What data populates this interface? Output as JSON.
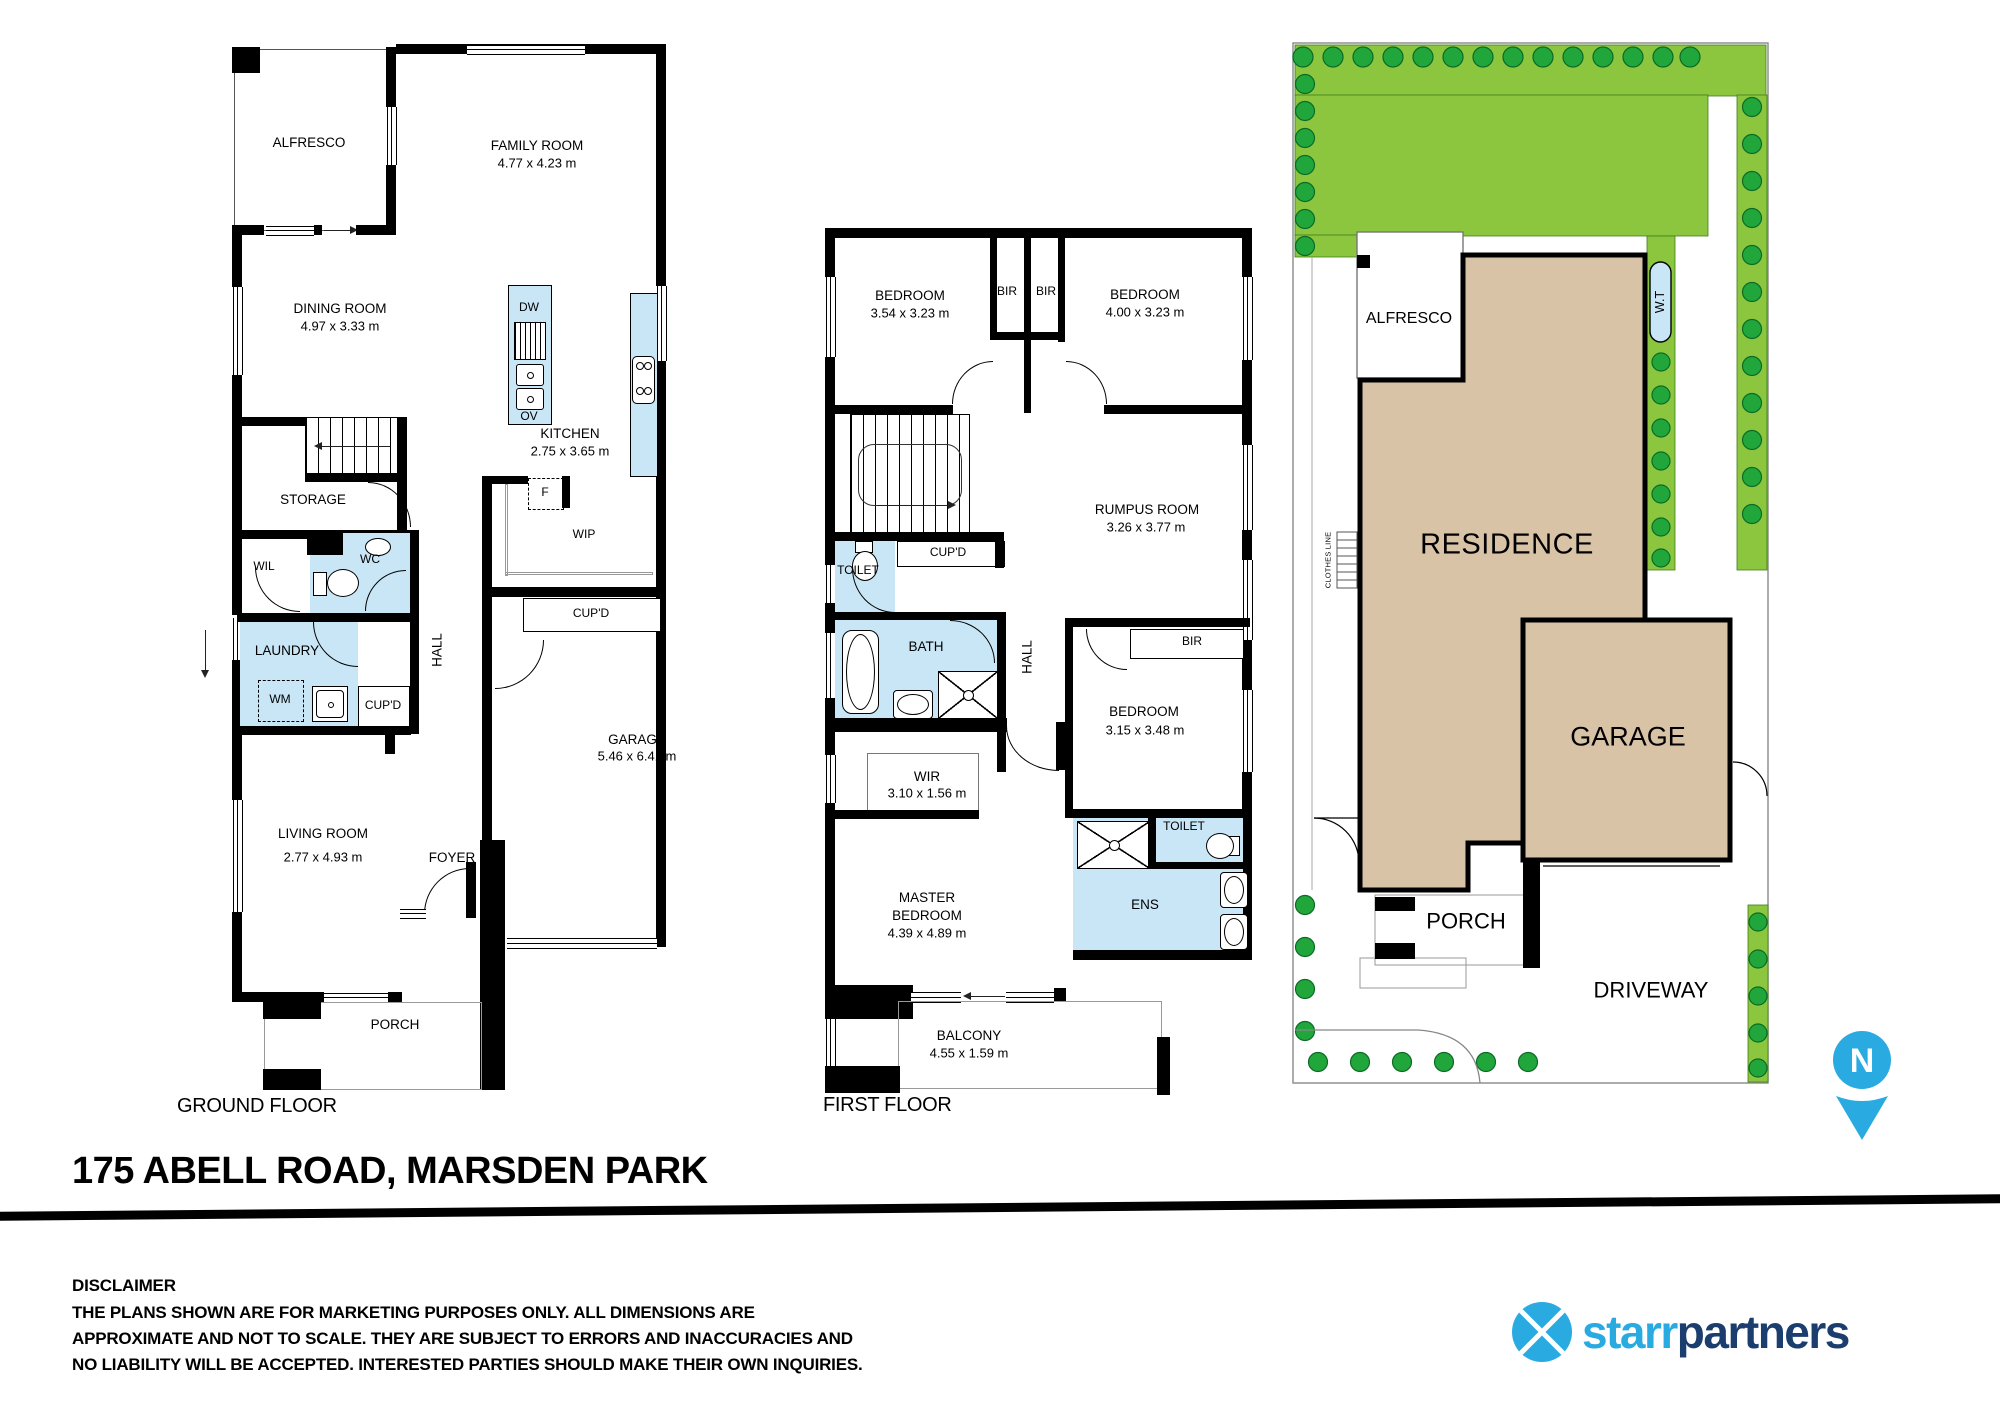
{
  "gf": {
    "floor": "GROUND FLOOR",
    "alfresco": "ALFRESCO",
    "family": {
      "n": "FAMILY ROOM",
      "d": "4.77 x 4.23 m"
    },
    "dining": {
      "n": "DINING ROOM",
      "d": "4.97 x 3.33 m"
    },
    "kitchen": {
      "n": "KITCHEN",
      "d": "2.75 x 3.65 m"
    },
    "dw": "DW",
    "ov": "OV",
    "fridge": "F",
    "wip": "WIP",
    "storage": "STORAGE",
    "wil": "WIL",
    "wc": "WC",
    "laundry": "LAUNDRY",
    "wm": "WM",
    "cupd_hall": "CUP'D",
    "hall": "HALL",
    "cupd_garage": "CUP'D",
    "garage": {
      "n": "GARAGE",
      "d": "5.46 x 6.41 m"
    },
    "living": {
      "n": "LIVING ROOM",
      "d": "2.77 x 4.93 m"
    },
    "foyer": "FOYER",
    "porch": "PORCH"
  },
  "ff": {
    "floor": "FIRST FLOOR",
    "bed1": {
      "n": "BEDROOM",
      "d": "3.54 x 3.23 m"
    },
    "bir1": "BIR",
    "bir2": "BIR",
    "bed2": {
      "n": "BEDROOM",
      "d": "4.00 x 3.23 m"
    },
    "rumpus": {
      "n": "RUMPUS ROOM",
      "d": "3.26 x 3.77 m"
    },
    "toilet1": "TOILET",
    "cupd": "CUP'D",
    "bath": "BATH",
    "hall": "HALL",
    "bir3": "BIR",
    "bed3": {
      "n": "BEDROOM",
      "d": "3.15 x 3.48 m"
    },
    "wir": {
      "n": "WIR",
      "d": "3.10 x 1.56 m"
    },
    "toilet2": "TOILET",
    "ens": "ENS",
    "master": {
      "l1": "MASTER",
      "l2": "BEDROOM",
      "d": "4.39 x 4.89 m"
    },
    "balcony": {
      "n": "BALCONY",
      "d": "4.55 x 1.59 m"
    }
  },
  "site": {
    "alfresco": "ALFRESCO",
    "wt": "W.T",
    "residence": "RESIDENCE",
    "clothes": "CLOTHES LINE",
    "garage": "GARAGE",
    "porch": "PORCH",
    "driveway": "DRIVEWAY",
    "north": "N"
  },
  "footer": {
    "title": "175 ABELL ROAD, MARSDEN PARK",
    "disclaimer_title": "DISCLAIMER",
    "d1": "THE PLANS SHOWN ARE FOR MARKETING PURPOSES ONLY. ALL DIMENSIONS ARE",
    "d2": "APPROXIMATE AND NOT TO SCALE. THEY ARE SUBJECT TO ERRORS AND INACCURACIES AND",
    "d3": "NO LIABILITY WILL BE ACCEPTED. INTERESTED PARTIES SHOULD MAKE THEIR OWN INQUIRIES.",
    "brand_a": "starr",
    "brand_b": "partners"
  },
  "colors": {
    "wet": "#C9E6F6",
    "lawn": "#8CC63F",
    "building": "#D8C3A6",
    "tree": "#21A63C",
    "pin_blue": "#29ABE2",
    "brand_navy": "#1C3E6E"
  }
}
